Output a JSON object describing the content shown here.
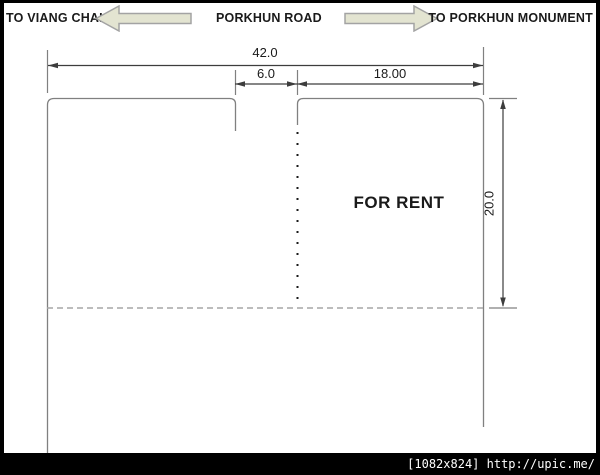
{
  "header": {
    "left_destination": "TO VIANG CHAI",
    "road_name": "PORKHUN ROAD",
    "right_destination": "TO PORKHUN MONUMENT"
  },
  "dimensions": {
    "total_frontage": "42.0",
    "gap_width": "6.0",
    "rent_frontage": "18.00",
    "depth": "20.0"
  },
  "plot": {
    "label": "FOR RENT"
  },
  "footer": {
    "caption": "[1082x824] http://upic.me/"
  },
  "icons": {
    "left_arrow": "left-road-direction-arrow",
    "right_arrow": "right-road-direction-arrow"
  },
  "colors": {
    "arrow_fill": "#e3e4d1",
    "arrow_border": "#a3a3a3",
    "outline_gray": "#808080",
    "dimension_line": "#3d3d3d",
    "dashed_line": "#a6a6a6",
    "footer_bg": "#000000",
    "footer_text": "#ffffff"
  }
}
